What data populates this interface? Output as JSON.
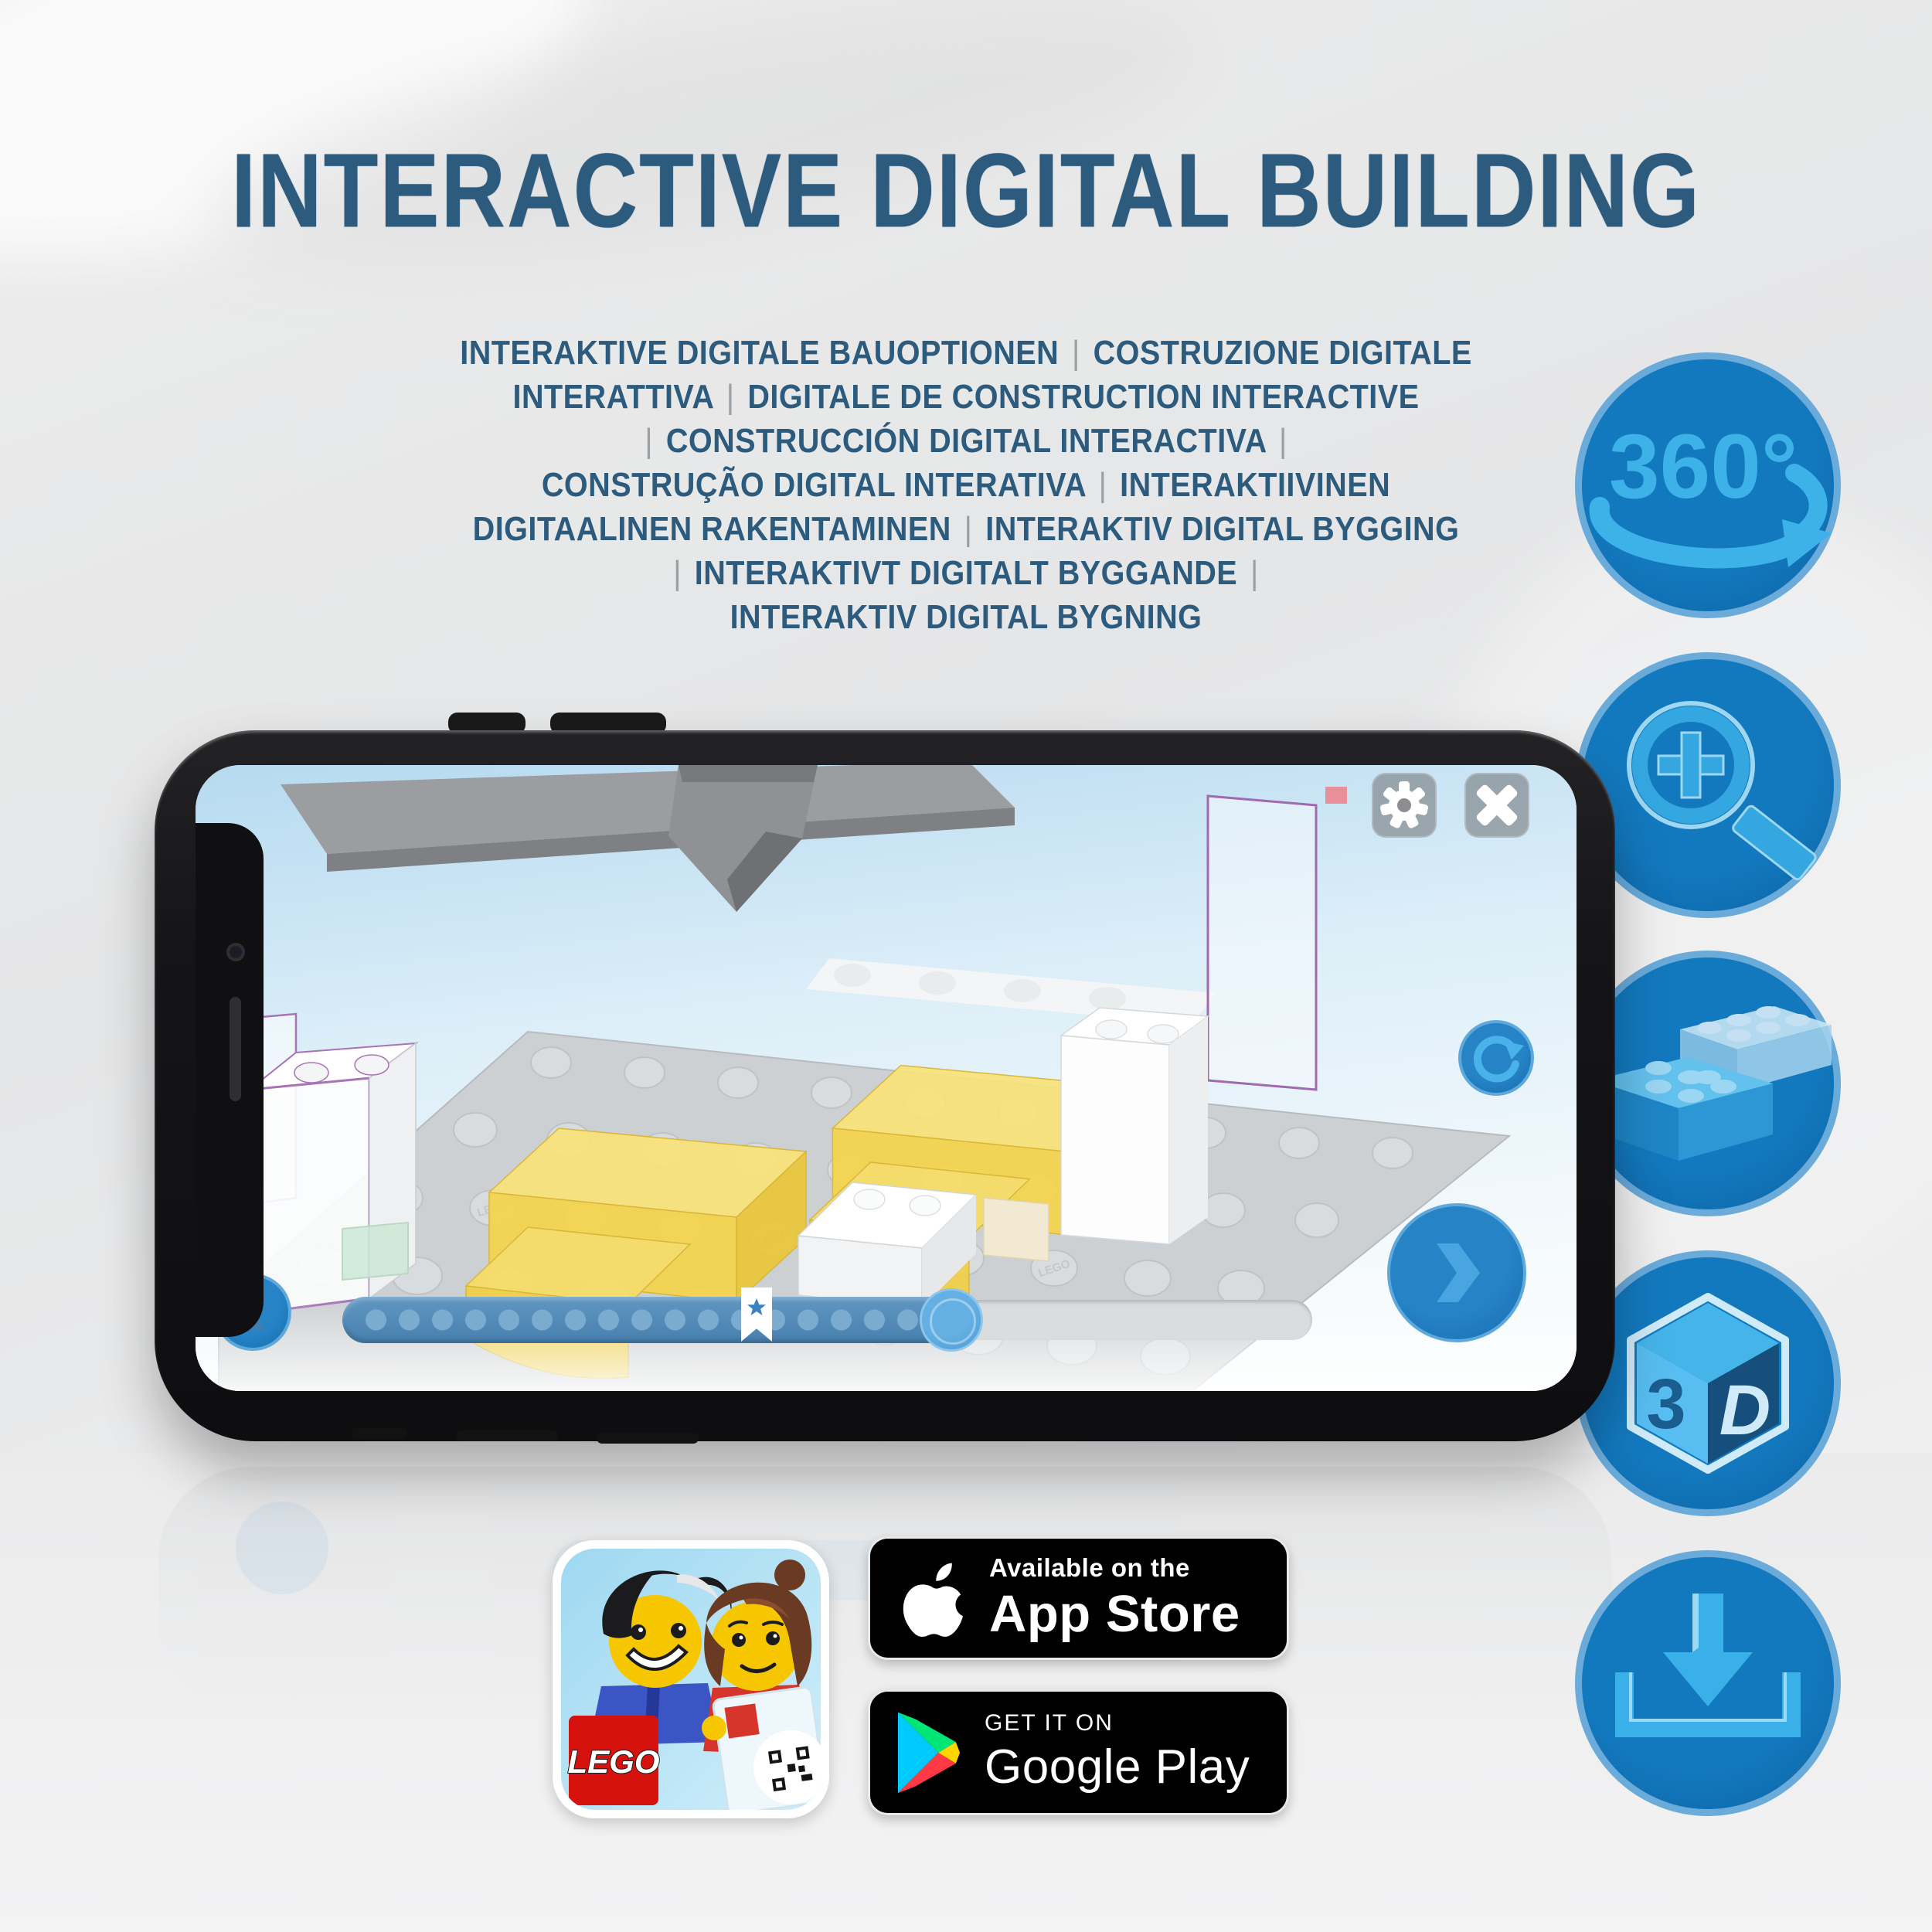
{
  "page": {
    "title": "INTERACTIVE DIGITAL BUILDING"
  },
  "paragraph": {
    "lines": [
      "INTERAKTIVE DIGITALE BAUOPTIONEN | COSTRUZIONE DIGITALE",
      "INTERATTIVA | DIGITALE DE CONSTRUCTION INTERACTIVE",
      "| CONSTRUCCIÓN DIGITAL INTERACTIVA |",
      "CONSTRUÇÃO DIGITAL INTERATIVA | INTERAKTIIVINEN",
      "DIGITAALINEN RAKENTAMINEN | INTERAKTIV DIGITAL BYGGING",
      "| INTERAKTIVT DIGITALT BYGGANDE |",
      "INTERAKTIV DIGITAL BYGNING"
    ]
  },
  "features": [
    {
      "name": "360-rotation",
      "label": "360°"
    },
    {
      "name": "zoom-magnifier",
      "label": ""
    },
    {
      "name": "brick-stacking",
      "label": ""
    },
    {
      "name": "3d-view",
      "chars": [
        "3",
        "D"
      ]
    },
    {
      "name": "download",
      "label": ""
    }
  ],
  "phone": {
    "stud_text": "LEGO"
  },
  "store_badges": {
    "app_store": {
      "line1": "Available on the",
      "line2": "App Store"
    },
    "google_play": {
      "line1": "GET IT ON",
      "line2": "Google Play"
    }
  },
  "app_icon": {
    "logo_text": "LEGO"
  },
  "colors": {
    "title_blue": "#2d5b7d",
    "circle_fill": "#1173ba",
    "circle_border": "#6aabda",
    "glyph_blue": "#3cb2e9",
    "progress_blue": "#477fae",
    "lego_red": "#d6120e",
    "badge_black": "#000000"
  }
}
